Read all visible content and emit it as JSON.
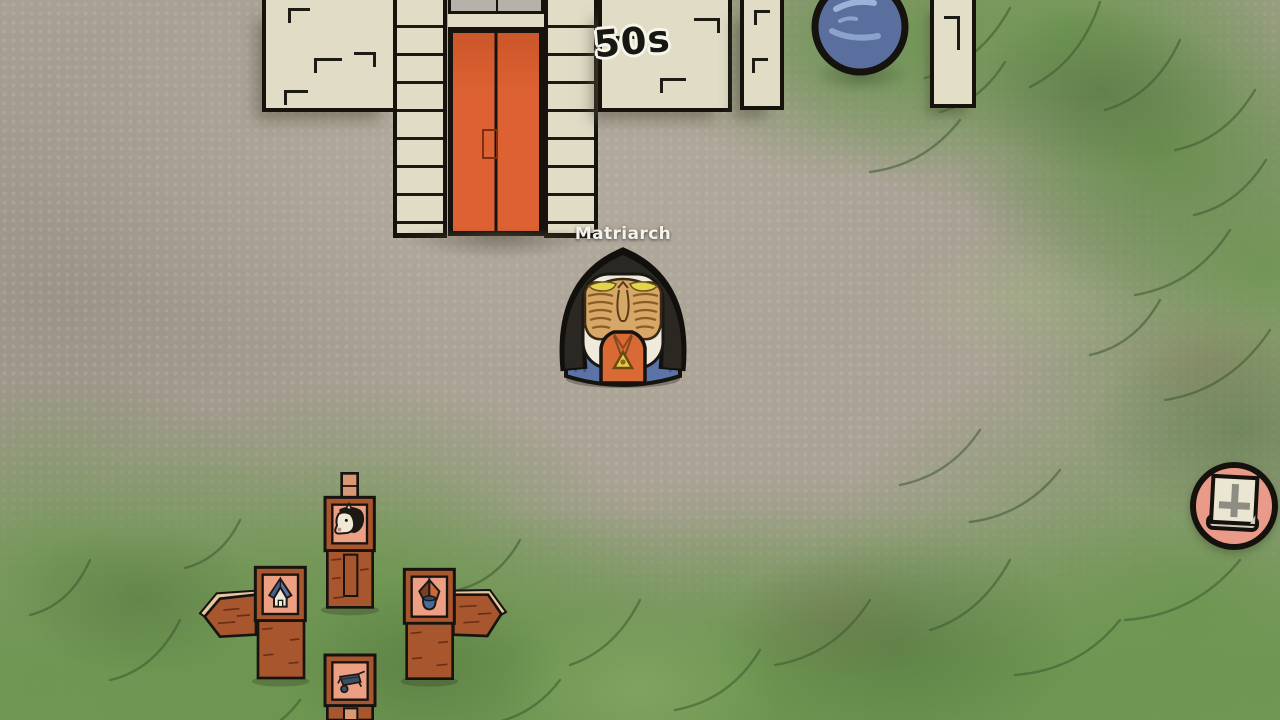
{
  "hud": {
    "currency_popup": "50s",
    "journal_button": {
      "icon": "book-cross-icon"
    }
  },
  "npc": {
    "name": "Matriarch"
  },
  "signs": {
    "north": {
      "icon": "horse-icon"
    },
    "west": {
      "icon": "house-icon"
    },
    "east": {
      "icon": "well-icon"
    },
    "south": {
      "icon": "wheelbarrow-icon"
    }
  },
  "scene": {
    "objects": [
      "farmhouse",
      "orange-double-door",
      "blue-orb",
      "stone-pillar",
      "signpost-cluster"
    ],
    "colors": {
      "dirt": "#a8a094",
      "grass": "#6d9650",
      "wall": "#e0dcc6",
      "door": "#dd6132",
      "wood": "#a8562e",
      "sign_panel": "#ec9f82",
      "orb": "#5a6f9d",
      "button_bg": "#ea9a88",
      "outline": "#16130d"
    }
  }
}
